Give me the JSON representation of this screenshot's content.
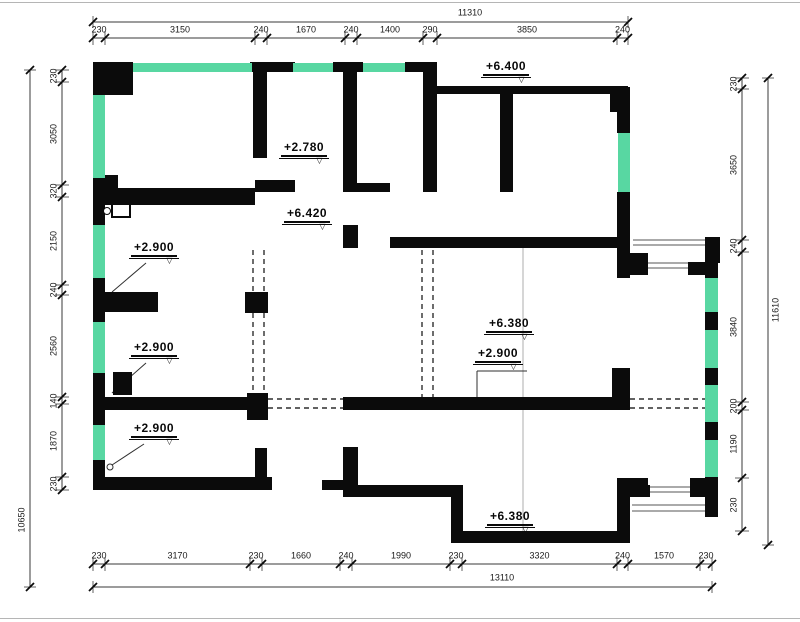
{
  "colors": {
    "wall": "#0b0b0b",
    "window": "#58d7a2",
    "dimline": "#3a3a3a"
  },
  "dimensions": {
    "top": {
      "total": {
        "label": "11310",
        "line_y": 22,
        "x1": 93,
        "x2": 628
      },
      "segments": {
        "line_y": 38,
        "label_y": 30,
        "ticks": [
          93,
          105,
          255,
          267,
          345,
          357,
          423,
          437,
          617,
          628
        ],
        "labels": [
          "230",
          "3150",
          "240",
          "1670",
          "240",
          "1400",
          "290",
          "3850",
          "240"
        ]
      }
    },
    "bottom": {
      "segments": {
        "line_y": 564,
        "label_y": 556,
        "ticks": [
          93,
          105,
          250,
          262,
          340,
          352,
          450,
          462,
          617,
          628,
          700,
          712
        ],
        "labels": [
          "230",
          "3170",
          "230",
          "1660",
          "240",
          "1990",
          "230",
          "3320",
          "240",
          "1570",
          "230"
        ]
      },
      "total": {
        "label": "13110",
        "line_y": 587,
        "x1": 93,
        "x2": 712
      }
    },
    "left": {
      "segments": {
        "line_x": 62,
        "label_x": 54,
        "ticks": [
          70,
          82,
          185,
          197,
          285,
          295,
          397,
          404,
          477,
          490
        ],
        "labels": [
          "230",
          "3050",
          "320",
          "2150",
          "240",
          "2560",
          "140",
          "1870",
          "230"
        ]
      },
      "total": {
        "label": "10650",
        "line_x": 30,
        "y1": 70,
        "y2": 587
      }
    },
    "right": {
      "segments": {
        "line_x": 742,
        "label_x": 734,
        "ticks": [
          78,
          89,
          240,
          252,
          402,
          410,
          478,
          531
        ],
        "labels": [
          "230",
          "3650",
          "240",
          "3840",
          "200",
          "1190",
          "230"
        ]
      },
      "total": {
        "label": "11610",
        "line_x": 768,
        "y1": 78,
        "y2": 545
      }
    }
  },
  "elevations": [
    {
      "text": "+6.400",
      "x": 483,
      "y": 60
    },
    {
      "text": "+2.780",
      "x": 281,
      "y": 141
    },
    {
      "text": "+6.420",
      "x": 284,
      "y": 207
    },
    {
      "text": "+2.900",
      "x": 131,
      "y": 241,
      "leader": [
        146,
        263,
        112,
        292
      ]
    },
    {
      "text": "+2.900",
      "x": 131,
      "y": 341,
      "leader": [
        146,
        363,
        112,
        393
      ]
    },
    {
      "text": "+2.900",
      "x": 131,
      "y": 422,
      "leader": [
        144,
        444,
        112,
        465
      ],
      "circle": [
        110,
        467
      ]
    },
    {
      "text": "+6.380",
      "x": 486,
      "y": 317
    },
    {
      "text": "+2.900",
      "x": 475,
      "y": 347,
      "bracket": [
        477,
        371,
        527,
        397
      ]
    },
    {
      "text": "+6.380",
      "x": 487,
      "y": 510
    }
  ],
  "walls": [
    [
      93,
      62,
      40,
      33
    ],
    [
      250,
      62,
      45,
      10
    ],
    [
      333,
      62,
      30,
      10
    ],
    [
      405,
      62,
      32,
      10
    ],
    [
      423,
      63,
      14,
      129
    ],
    [
      93,
      175,
      25,
      18
    ],
    [
      93,
      178,
      12,
      47
    ],
    [
      105,
      188,
      150,
      17
    ],
    [
      253,
      62,
      14,
      96
    ],
    [
      255,
      180,
      40,
      12
    ],
    [
      343,
      63,
      14,
      129
    ],
    [
      357,
      183,
      33,
      9
    ],
    [
      343,
      225,
      15,
      23
    ],
    [
      437,
      86,
      191,
      8
    ],
    [
      610,
      93,
      18,
      19
    ],
    [
      617,
      87,
      13,
      46
    ],
    [
      617,
      192,
      13,
      56
    ],
    [
      500,
      93,
      13,
      99
    ],
    [
      390,
      237,
      240,
      11
    ],
    [
      617,
      248,
      13,
      30
    ],
    [
      705,
      237,
      15,
      26
    ],
    [
      630,
      253,
      18,
      22
    ],
    [
      688,
      262,
      17,
      13
    ],
    [
      705,
      263,
      13,
      15
    ],
    [
      705,
      312,
      13,
      18
    ],
    [
      705,
      368,
      13,
      17
    ],
    [
      705,
      422,
      13,
      18
    ],
    [
      705,
      477,
      13,
      40
    ],
    [
      93,
      278,
      12,
      44
    ],
    [
      105,
      292,
      53,
      20
    ],
    [
      245,
      292,
      23,
      21
    ],
    [
      93,
      373,
      12,
      52
    ],
    [
      113,
      372,
      19,
      23
    ],
    [
      105,
      397,
      143,
      13
    ],
    [
      247,
      393,
      21,
      27
    ],
    [
      343,
      397,
      269,
      13
    ],
    [
      612,
      368,
      18,
      42
    ],
    [
      93,
      460,
      12,
      30
    ],
    [
      93,
      477,
      179,
      13
    ],
    [
      255,
      448,
      12,
      29
    ],
    [
      322,
      480,
      26,
      10
    ],
    [
      343,
      447,
      15,
      50
    ],
    [
      345,
      485,
      118,
      12
    ],
    [
      451,
      490,
      12,
      53
    ],
    [
      451,
      531,
      179,
      12
    ],
    [
      617,
      478,
      13,
      65
    ],
    [
      630,
      478,
      18,
      12
    ],
    [
      630,
      485,
      20,
      12
    ],
    [
      690,
      478,
      15,
      19
    ]
  ],
  "windows": [
    [
      133,
      63,
      119,
      9
    ],
    [
      293,
      63,
      40,
      9
    ],
    [
      363,
      63,
      42,
      9
    ],
    [
      93,
      95,
      12,
      83
    ],
    [
      93,
      225,
      12,
      53
    ],
    [
      93,
      322,
      12,
      51
    ],
    [
      93,
      425,
      12,
      35
    ],
    [
      618,
      133,
      12,
      59
    ],
    [
      705,
      278,
      13,
      34
    ],
    [
      705,
      330,
      13,
      38
    ],
    [
      705,
      385,
      13,
      37
    ],
    [
      705,
      440,
      13,
      37
    ]
  ],
  "railings": [
    [
      633,
      240,
      705,
      240
    ],
    [
      633,
      245,
      705,
      245
    ],
    [
      648,
      263,
      688,
      263
    ],
    [
      648,
      268,
      688,
      268
    ],
    [
      650,
      487,
      690,
      487
    ],
    [
      650,
      492,
      690,
      492
    ],
    [
      632,
      505,
      705,
      505
    ],
    [
      632,
      511,
      705,
      511
    ]
  ],
  "dashed": [
    [
      268,
      399,
      343,
      399
    ],
    [
      268,
      408,
      343,
      408
    ],
    [
      630,
      399,
      705,
      399
    ],
    [
      630,
      408,
      705,
      408
    ],
    [
      253,
      250,
      253,
      393
    ],
    [
      264,
      250,
      264,
      393
    ],
    [
      422,
      250,
      422,
      397
    ],
    [
      433,
      250,
      433,
      397
    ]
  ],
  "gridlines": [
    [
      523,
      248,
      523,
      531
    ]
  ],
  "door_symbol": {
    "rect": [
      111,
      203
    ],
    "circle": [
      103,
      207
    ]
  }
}
